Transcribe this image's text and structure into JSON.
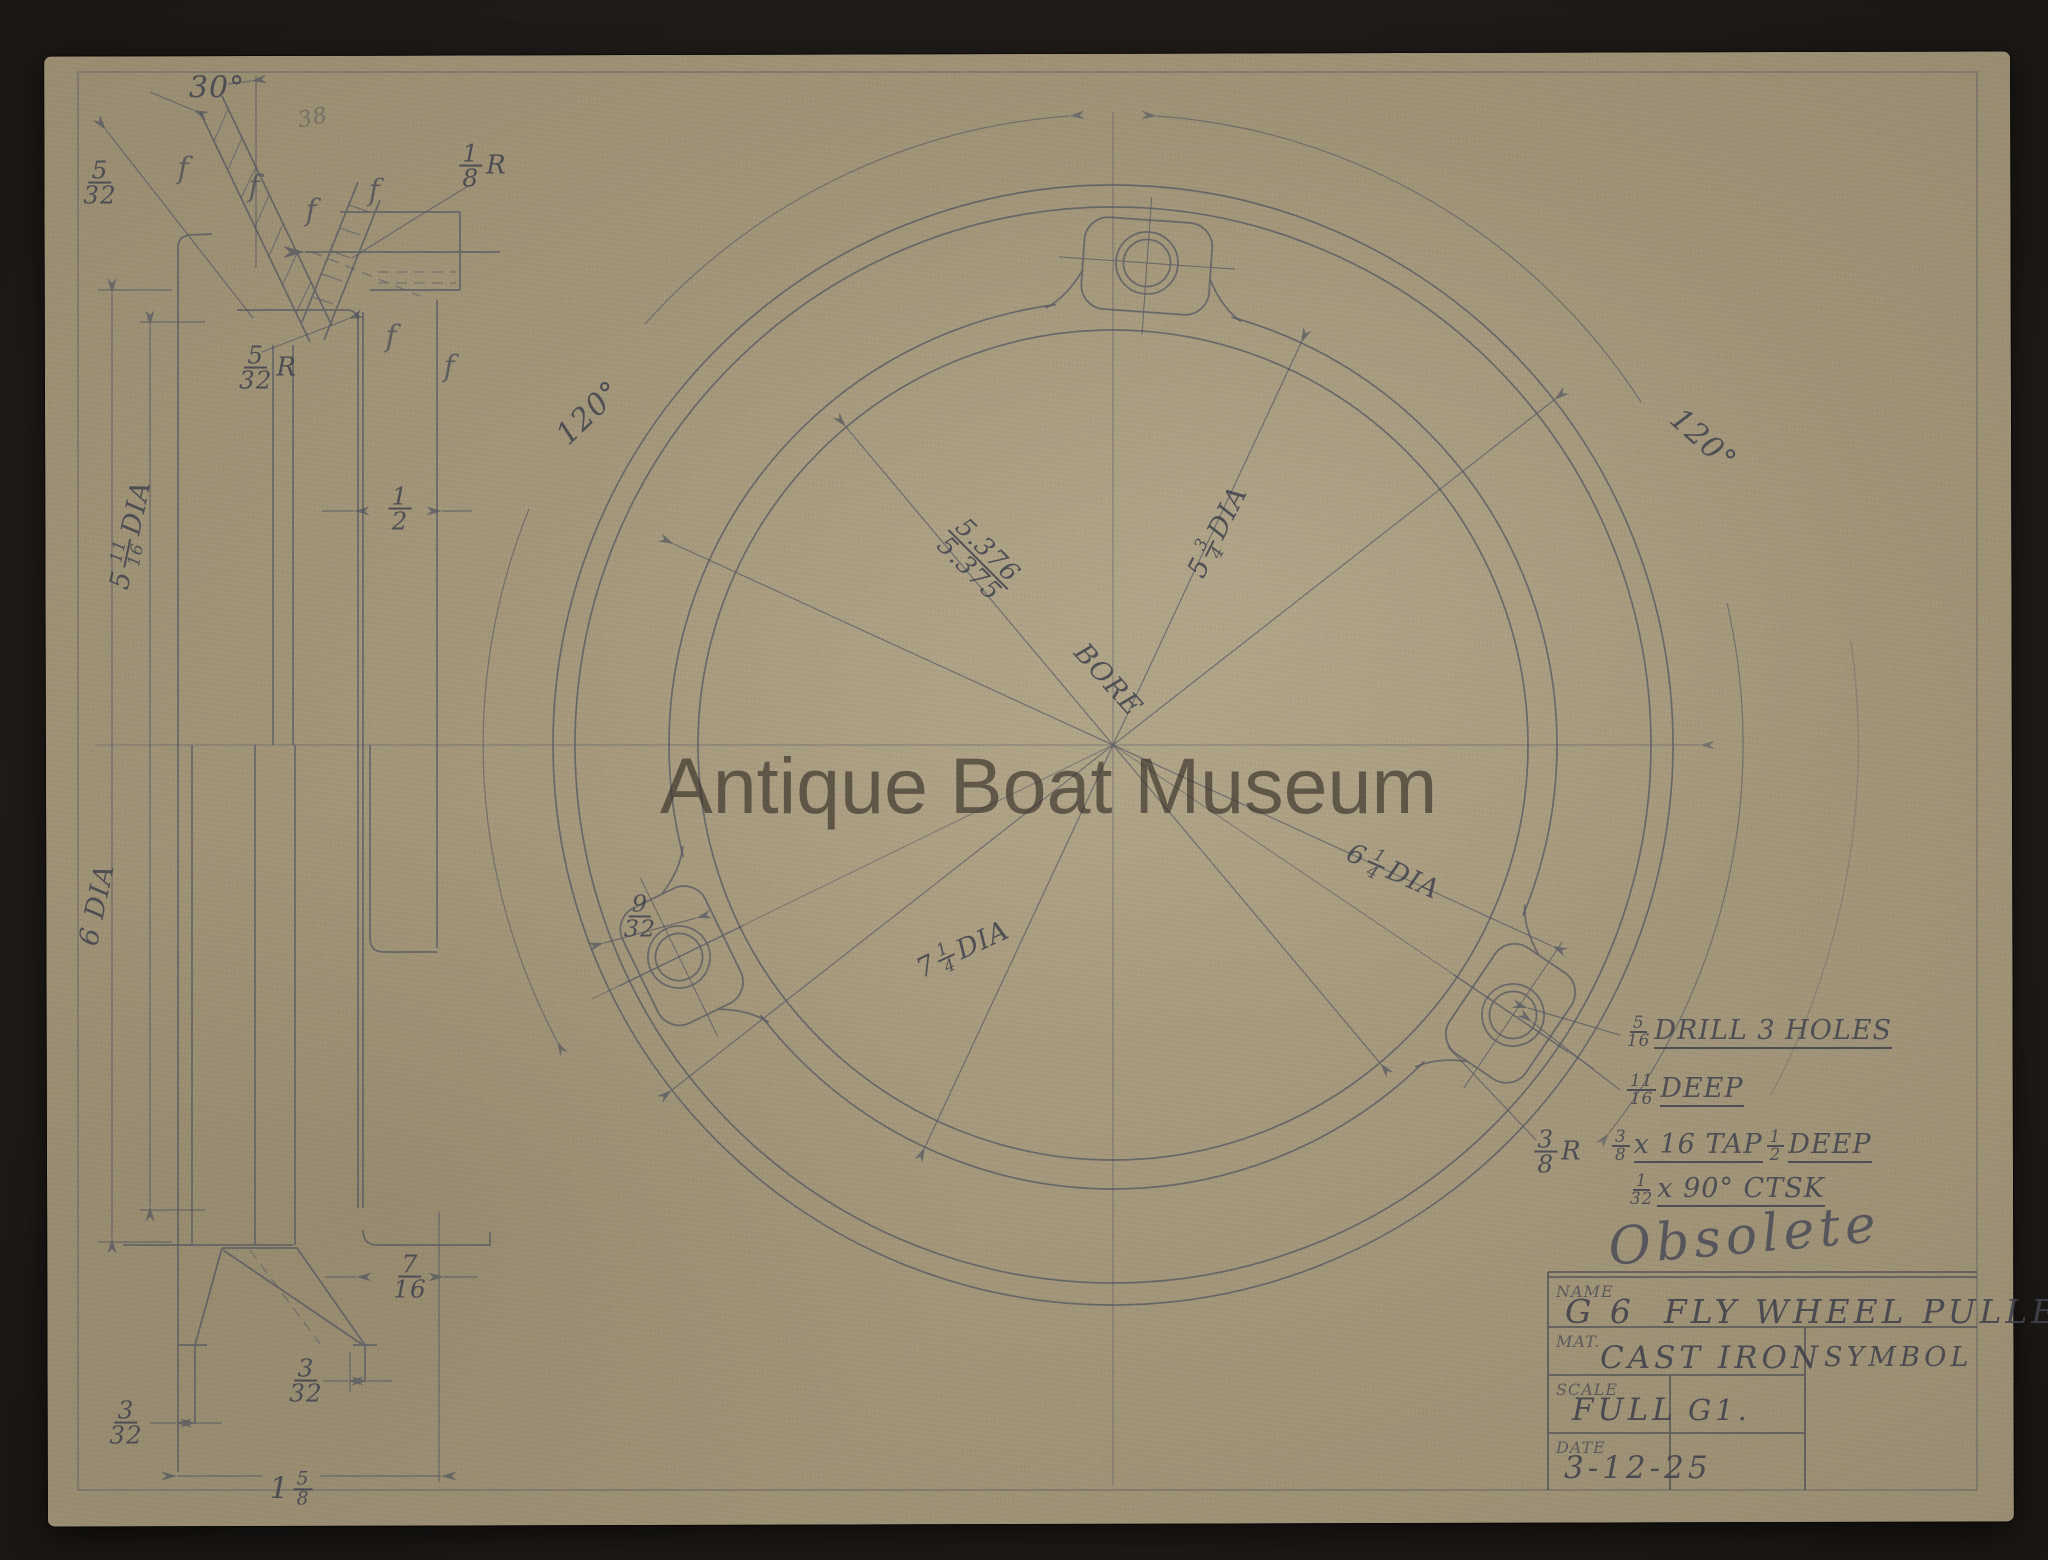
{
  "watermark": "Antique Boat Museum",
  "stamp": "Obsolete",
  "title_block": {
    "name_label": "NAME",
    "name": "G 6  FLY WHEEL PULLEY",
    "mat_label": "MAT.",
    "material": "CAST IRON",
    "symbol_label": "SYMBOL",
    "scale_label": "SCALE",
    "scale": "FULL",
    "drawing_code": "G1.",
    "date_label": "DATE",
    "date": "3-12-25"
  },
  "colors": {
    "paper": "#ac9f82",
    "surround": "#1a1714",
    "pencil": "#4f5360",
    "lettering": "#43454f"
  },
  "finish_marks": {
    "glyph": "f",
    "positions": [
      [
        183,
        169
      ],
      [
        254,
        187
      ],
      [
        311,
        211
      ],
      [
        374,
        191
      ],
      [
        391,
        337
      ],
      [
        449,
        367
      ]
    ]
  },
  "labels": [
    {
      "id": "angle-30",
      "x": 217,
      "y": 88,
      "size": 30,
      "parts": [
        {
          "t": "30°"
        }
      ]
    },
    {
      "id": "note-38",
      "x": 313,
      "y": 118,
      "size": 22,
      "rot": -12,
      "cls": "faint",
      "parts": [
        {
          "t": "38"
        }
      ]
    },
    {
      "id": "dim-5-32-groove",
      "x": 100,
      "y": 183,
      "size": 26,
      "cls": "fl",
      "parts": [
        {
          "f": [
            "5",
            "32"
          ]
        }
      ]
    },
    {
      "id": "dim-1-8-r",
      "x": 483,
      "y": 166,
      "size": 26,
      "cls": "fl",
      "parts": [
        {
          "f": [
            "1",
            "8"
          ]
        },
        {
          "t": "R"
        }
      ]
    },
    {
      "id": "dim-5-32-r",
      "x": 268,
      "y": 368,
      "size": 26,
      "cls": "fl",
      "parts": [
        {
          "f": [
            "5",
            "32"
          ]
        },
        {
          "t": "R"
        }
      ]
    },
    {
      "id": "dim-half",
      "x": 400,
      "y": 509,
      "size": 26,
      "cls": "fl",
      "parts": [
        {
          "f": [
            "1",
            "2"
          ]
        }
      ]
    },
    {
      "id": "dim-5-11-16-dia",
      "x": 131,
      "y": 535,
      "size": 27,
      "rot": -78,
      "parts": [
        {
          "t": "5"
        },
        {
          "f": [
            "11",
            "16"
          ]
        },
        {
          "t": " DIA"
        }
      ]
    },
    {
      "id": "dim-6-dia",
      "x": 97,
      "y": 905,
      "size": 27,
      "rot": -78,
      "parts": [
        {
          "t": "6 DIA"
        }
      ]
    },
    {
      "id": "dim-7-16",
      "x": 410,
      "y": 1277,
      "size": 26,
      "cls": "fl",
      "parts": [
        {
          "f": [
            "7",
            "16"
          ]
        }
      ]
    },
    {
      "id": "dim-3-32-mid",
      "x": 306,
      "y": 1381,
      "size": 26,
      "cls": "fl",
      "parts": [
        {
          "f": [
            "3",
            "32"
          ]
        }
      ]
    },
    {
      "id": "dim-3-32-left",
      "x": 126,
      "y": 1423,
      "size": 26,
      "cls": "fl",
      "parts": [
        {
          "f": [
            "3",
            "32"
          ]
        }
      ]
    },
    {
      "id": "dim-1-5-8",
      "x": 291,
      "y": 1489,
      "size": 30,
      "parts": [
        {
          "t": "1"
        },
        {
          "f": [
            "5",
            "8"
          ]
        }
      ]
    },
    {
      "id": "angle-120-left",
      "x": 589,
      "y": 413,
      "size": 30,
      "rot": -44,
      "parts": [
        {
          "t": "120°"
        }
      ]
    },
    {
      "id": "angle-120-right",
      "x": 1703,
      "y": 440,
      "size": 30,
      "rot": 42,
      "parts": [
        {
          "t": "120°"
        }
      ]
    },
    {
      "id": "dim-bore-frac",
      "x": 978,
      "y": 560,
      "size": 27,
      "rot": 45,
      "cls": "fl",
      "parts": [
        {
          "f": [
            "5.376",
            "5.375"
          ]
        }
      ]
    },
    {
      "id": "dim-bore-word",
      "x": 1108,
      "y": 680,
      "size": 27,
      "rot": 48,
      "parts": [
        {
          "t": "BORE"
        }
      ]
    },
    {
      "id": "dim-5-3-4-dia",
      "x": 1218,
      "y": 532,
      "size": 27,
      "rot": -63,
      "parts": [
        {
          "t": "5"
        },
        {
          "f": [
            "3",
            "4"
          ]
        },
        {
          "t": " DIA"
        }
      ]
    },
    {
      "id": "dim-6-1-4-dia",
      "x": 1393,
      "y": 872,
      "size": 27,
      "rot": 24,
      "parts": [
        {
          "t": "6"
        },
        {
          "f": [
            "1",
            "4"
          ]
        },
        {
          "t": " DIA"
        }
      ]
    },
    {
      "id": "dim-7-1-4-dia",
      "x": 963,
      "y": 950,
      "size": 27,
      "rot": -25,
      "parts": [
        {
          "t": "7"
        },
        {
          "f": [
            "1",
            "4"
          ]
        },
        {
          "t": " DIA"
        }
      ]
    },
    {
      "id": "dim-9-32",
      "x": 640,
      "y": 916,
      "size": 25,
      "cls": "fl",
      "parts": [
        {
          "f": [
            "9",
            "32"
          ]
        }
      ]
    },
    {
      "id": "note-drill",
      "x": 1627,
      "y": 1032,
      "size": 27,
      "anchor": "left",
      "parts": [
        {
          "f": [
            "5",
            "16"
          ]
        },
        {
          "t": "DRILL 3 HOLES",
          "u": 1
        }
      ]
    },
    {
      "id": "note-deep",
      "x": 1627,
      "y": 1090,
      "size": 27,
      "anchor": "left",
      "parts": [
        {
          "f": [
            "11",
            "16"
          ]
        },
        {
          "t": "DEEP",
          "u": 1
        }
      ]
    },
    {
      "id": "note-tap",
      "x": 1612,
      "y": 1146,
      "size": 27,
      "anchor": "left",
      "parts": [
        {
          "f": [
            "3",
            "8"
          ]
        },
        {
          "t": "x 16 TAP",
          "u": 1
        },
        {
          "f": [
            "1",
            "2"
          ]
        },
        {
          "t": "DEEP",
          "u": 1
        }
      ]
    },
    {
      "id": "note-ctsk",
      "x": 1630,
      "y": 1190,
      "size": 27,
      "anchor": "left",
      "parts": [
        {
          "f": [
            "1",
            "32"
          ]
        },
        {
          "t": "x 90° CTSK",
          "u": 1
        }
      ]
    },
    {
      "id": "dim-3-8-r",
      "x": 1558,
      "y": 1152,
      "size": 26,
      "cls": "fl",
      "parts": [
        {
          "f": [
            "3",
            "8"
          ]
        },
        {
          "t": "R"
        }
      ]
    }
  ]
}
